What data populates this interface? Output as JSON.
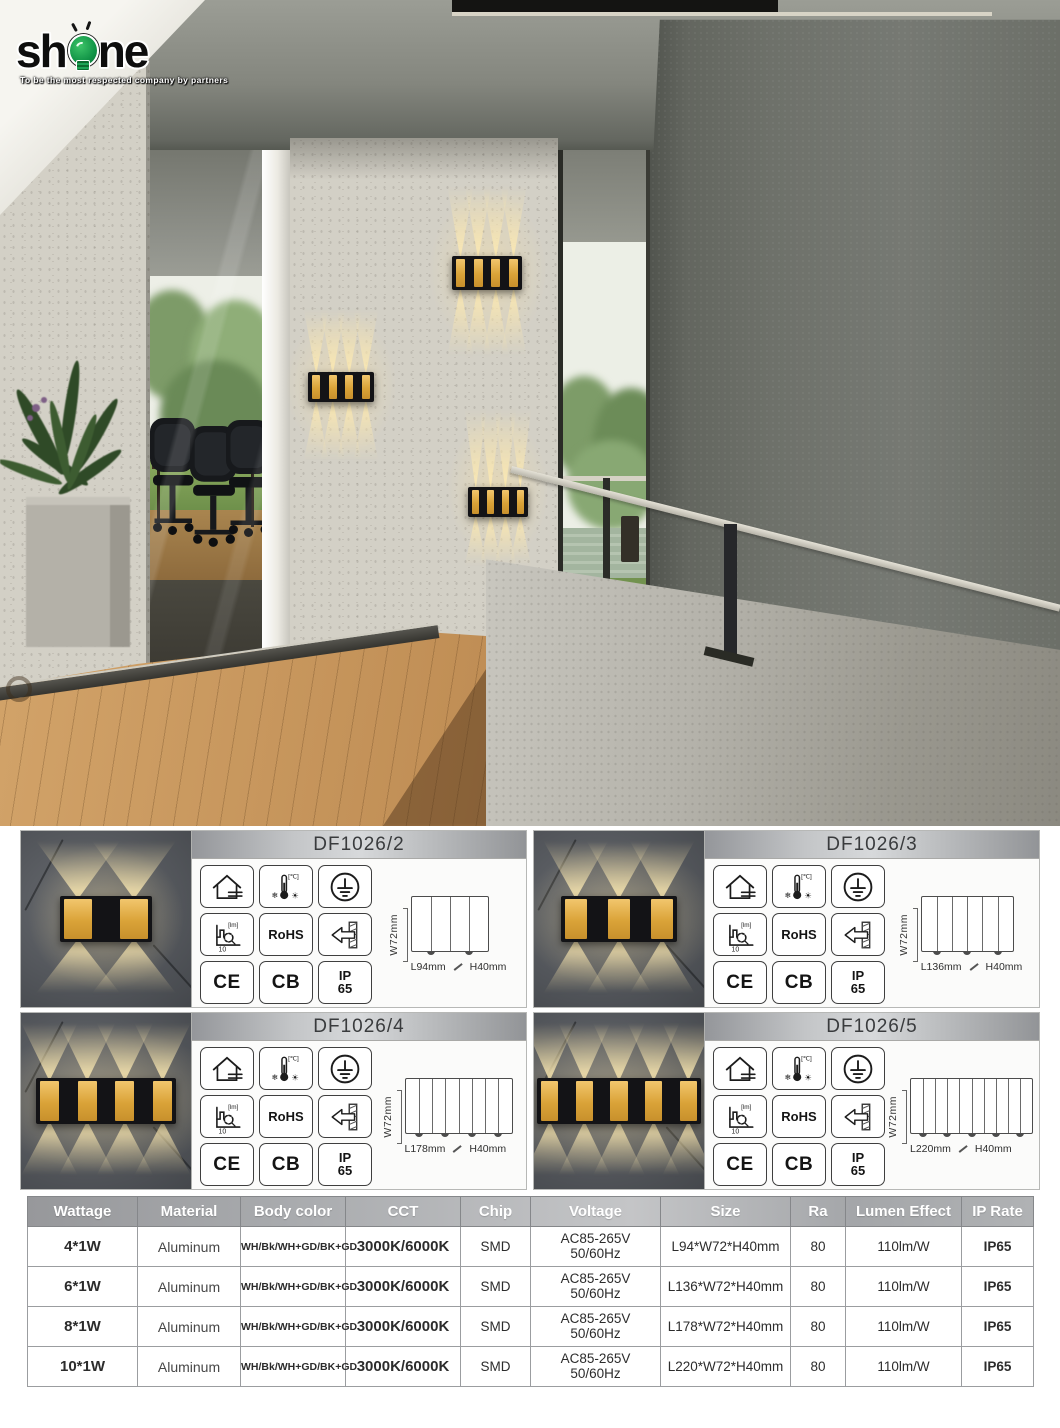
{
  "logo": {
    "brand": "shine",
    "brand_prefix": "sh",
    "brand_suffix": "ne",
    "tagline": "To be the most respected company by partners",
    "bulb_color": "#129447"
  },
  "hero": {
    "lamps": [
      {
        "stripes": 4
      },
      {
        "stripes": 4
      },
      {
        "stripes": 4
      }
    ]
  },
  "panels": [
    {
      "model": "DF1026/2",
      "beams": 2,
      "width_label": "W72mm",
      "length_label": "L94mm",
      "height_label": "H40mm"
    },
    {
      "model": "DF1026/3",
      "beams": 3,
      "width_label": "W72mm",
      "length_label": "L136mm",
      "height_label": "H40mm"
    },
    {
      "model": "DF1026/4",
      "beams": 4,
      "width_label": "W72mm",
      "length_label": "L178mm",
      "height_label": "H40mm"
    },
    {
      "model": "DF1026/5",
      "beams": 5,
      "width_label": "W72mm",
      "length_label": "L220mm",
      "height_label": "H40mm"
    }
  ],
  "cert_icons": {
    "temp_unit": "[℃]",
    "snow": "❄",
    "sun": "☀",
    "lumen_unit": "[lm]",
    "lumen_value": "10",
    "rohs": "RoHS",
    "ce": "CE",
    "cb": "CB",
    "ip_top": "IP",
    "ip_bottom": "65",
    "names": [
      "indoor-outdoor-house-icon",
      "temperature-range-icon",
      "earth-ground-icon",
      "lumen-output-icon",
      "rohs-mark",
      "wall-mount-icon",
      "ce-mark",
      "cb-mark",
      "ip65-mark"
    ]
  },
  "spec_table": {
    "headers": [
      "Wattage",
      "Material",
      "Body color",
      "CCT",
      "Chip",
      "Voltage",
      "Size",
      "Ra",
      "Lumen Effect",
      "IP Rate"
    ],
    "rows": [
      {
        "wattage": "4*1W",
        "material": "Aluminum",
        "body_color": "WH/Bk/WH+GD/BK+GD",
        "cct": "3000K/6000K",
        "chip": "SMD",
        "voltage_line1": "AC85-265V",
        "voltage_line2": "50/60Hz",
        "size": "L94*W72*H40mm",
        "ra": "80",
        "lumen_effect": "110lm/W",
        "ip_rate": "IP65"
      },
      {
        "wattage": "6*1W",
        "material": "Aluminum",
        "body_color": "WH/Bk/WH+GD/BK+GD",
        "cct": "3000K/6000K",
        "chip": "SMD",
        "voltage_line1": "AC85-265V",
        "voltage_line2": "50/60Hz",
        "size": "L136*W72*H40mm",
        "ra": "80",
        "lumen_effect": "110lm/W",
        "ip_rate": "IP65"
      },
      {
        "wattage": "8*1W",
        "material": "Aluminum",
        "body_color": "WH/Bk/WH+GD/BK+GD",
        "cct": "3000K/6000K",
        "chip": "SMD",
        "voltage_line1": "AC85-265V",
        "voltage_line2": "50/60Hz",
        "size": "L178*W72*H40mm",
        "ra": "80",
        "lumen_effect": "110lm/W",
        "ip_rate": "IP65"
      },
      {
        "wattage": "10*1W",
        "material": "Aluminum",
        "body_color": "WH/Bk/WH+GD/BK+GD",
        "cct": "3000K/6000K",
        "chip": "SMD",
        "voltage_line1": "AC85-265V",
        "voltage_line2": "50/60Hz",
        "size": "L220*W72*H40mm",
        "ra": "80",
        "lumen_effect": "110lm/W",
        "ip_rate": "IP65"
      }
    ]
  },
  "colors": {
    "gold": "#d9a43c",
    "lamp_black": "#131316",
    "beam_warm": "#fce9b2",
    "accent_green": "#129447",
    "header_text": "#ffffff"
  }
}
